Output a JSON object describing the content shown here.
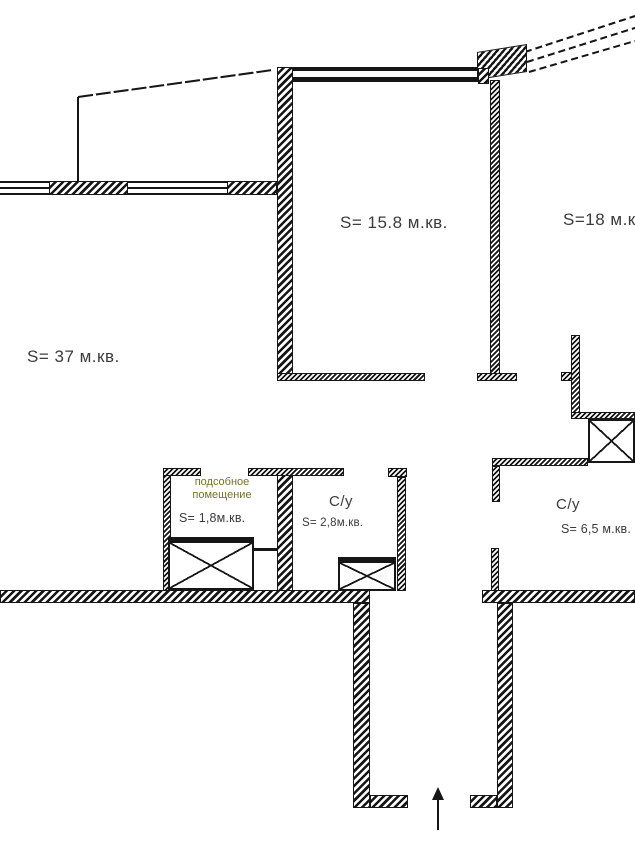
{
  "drawing": {
    "kind": "apartment floor plan",
    "rooms": {
      "living": {
        "area_label": "S= 37 м.кв."
      },
      "bedroom": {
        "area_label": "S= 15.8 м.кв."
      },
      "room18": {
        "area_label": "S=18 м.кв."
      },
      "utility": {
        "name_line1": "подсобное",
        "name_line2": "помещение",
        "area_label": "S= 1,8м.кв."
      },
      "wc_small": {
        "name": "С/у",
        "area_label": "S= 2,8м.кв."
      },
      "wc_large": {
        "name": "С/у",
        "area_label": "S= 6,5 м.кв."
      }
    },
    "colors": {
      "ink": "#161616",
      "label_text": "#3b3b3b",
      "utility_name_text": "#73732c"
    }
  }
}
